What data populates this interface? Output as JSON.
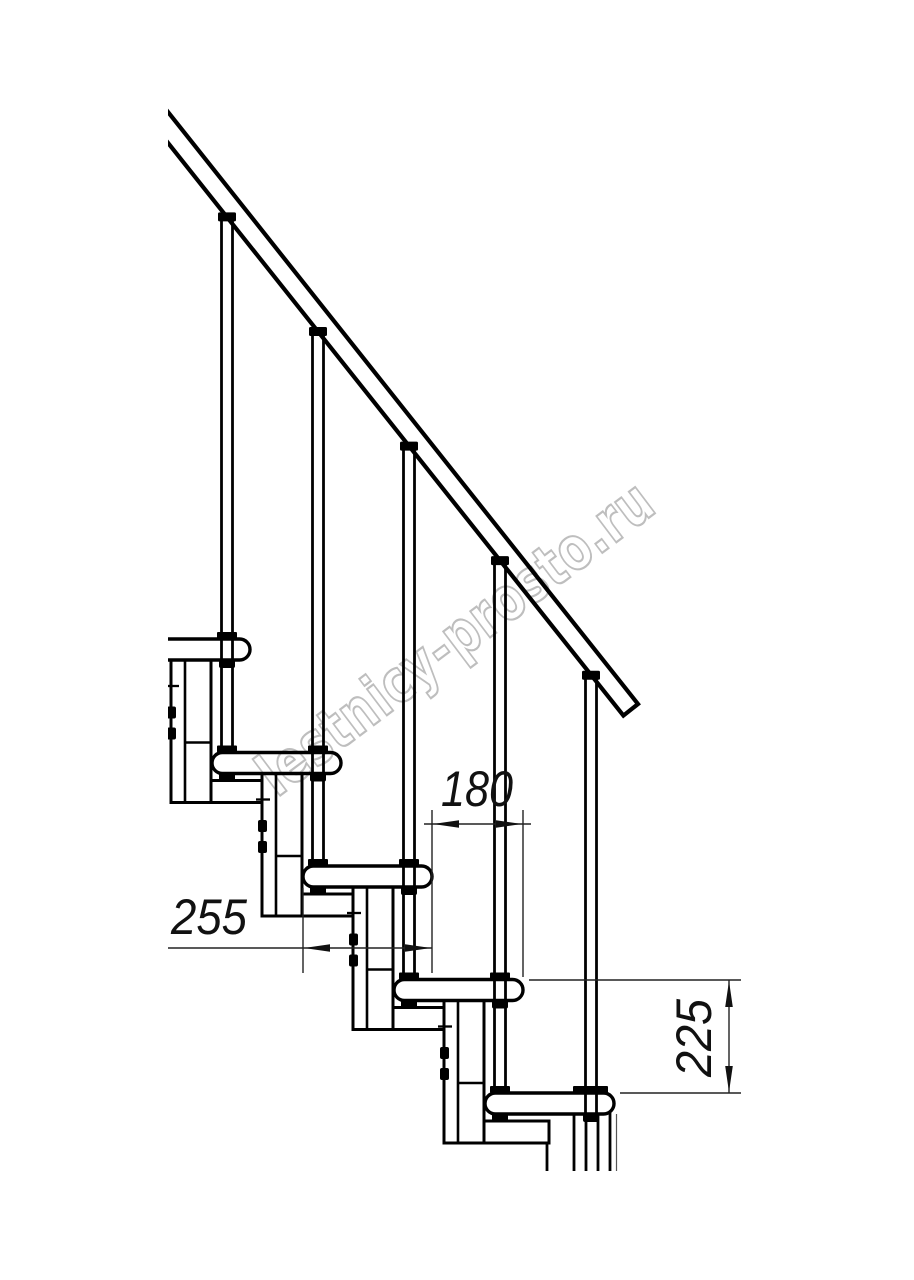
{
  "drawing": {
    "kind": "staircase-side-view-technical-drawing",
    "dimensions": {
      "step_run": {
        "value": "180",
        "orientation": "horizontal"
      },
      "tread_depth": {
        "value": "255",
        "orientation": "horizontal"
      },
      "step_rise": {
        "value": "225",
        "orientation": "vertical"
      }
    },
    "watermark": {
      "text": "lestnicy-prosto.ru",
      "color": "#b3b3b3"
    },
    "colors": {
      "line": "#000000",
      "background": "#ffffff",
      "dimension_text": "#111111"
    }
  }
}
